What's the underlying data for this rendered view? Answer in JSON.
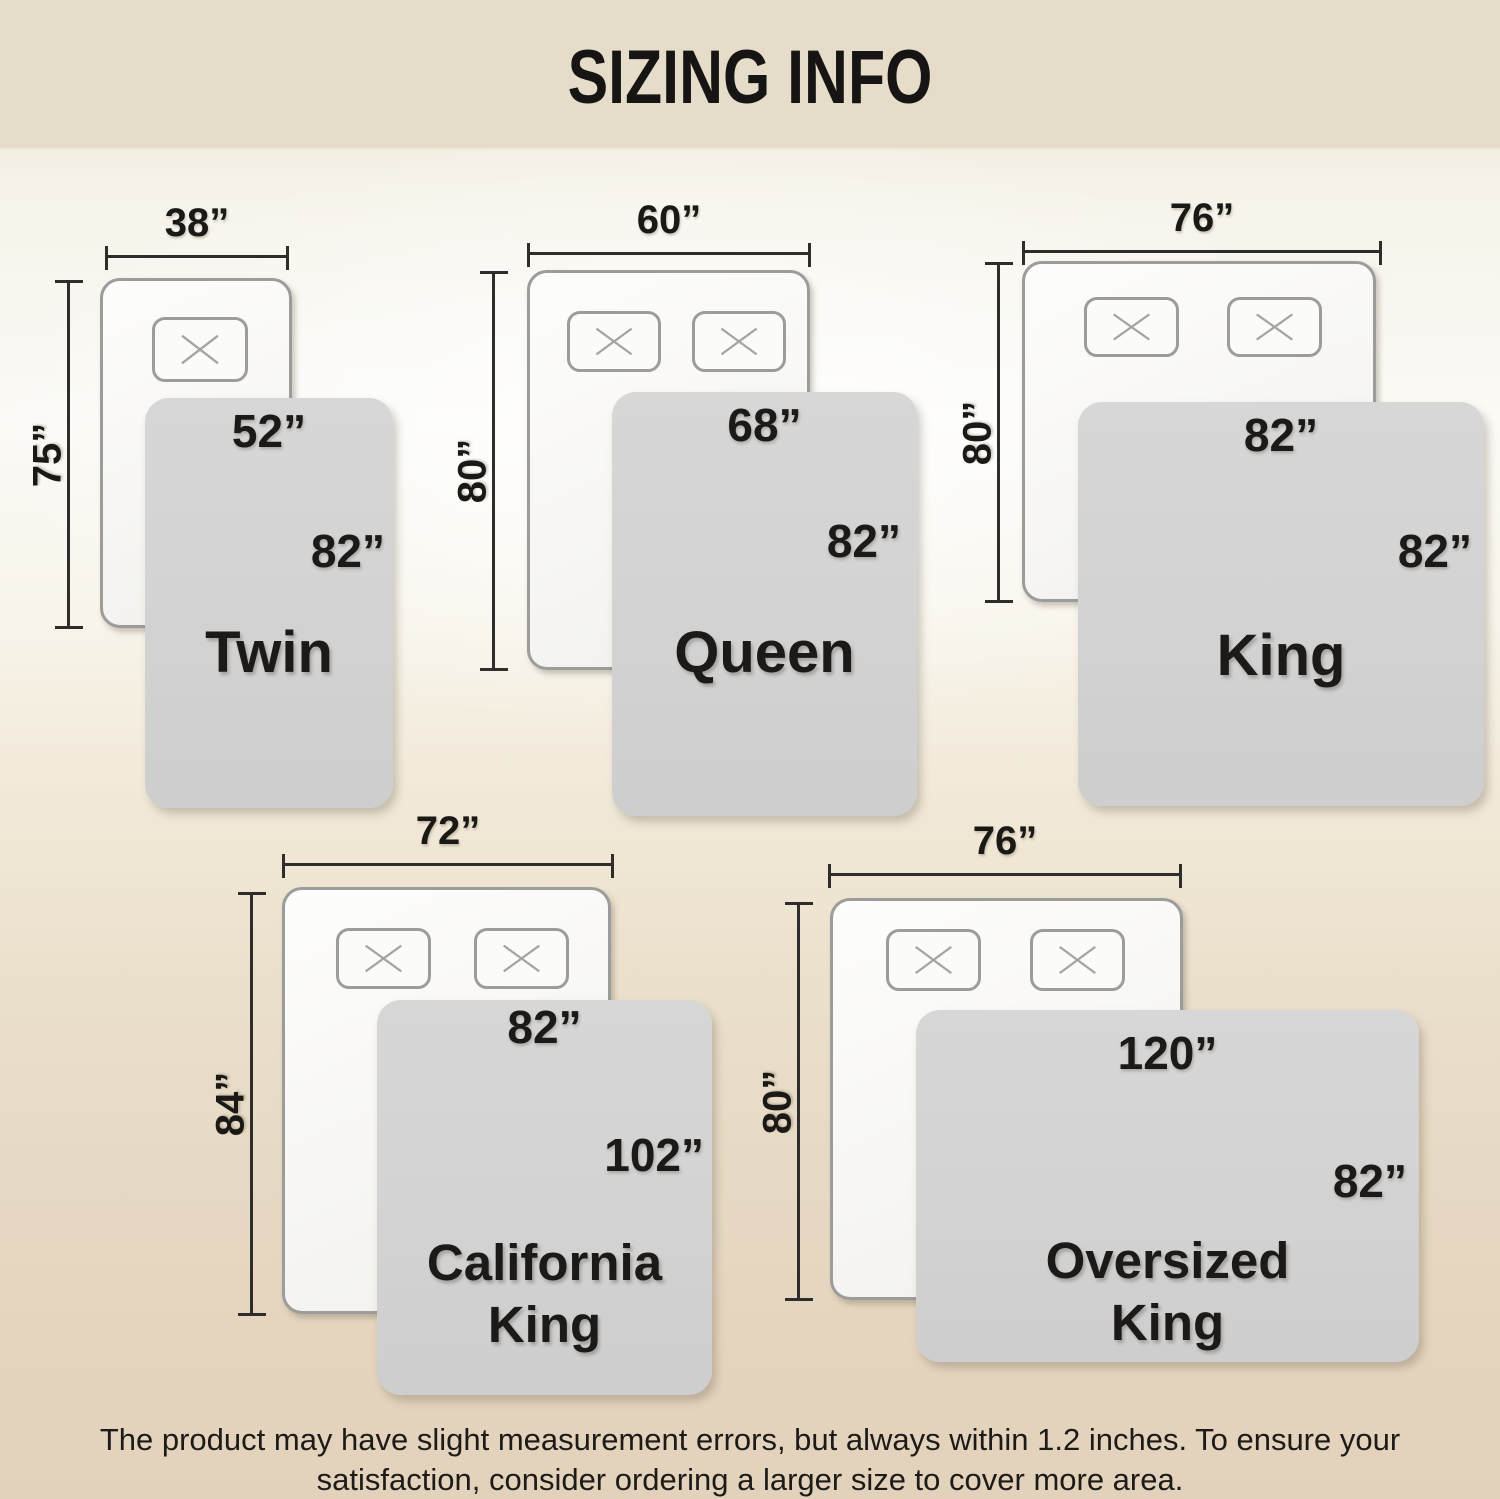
{
  "title": "SIZING INFO",
  "colors": {
    "header_bg": "#e5dcc9",
    "background_bottom": "#e3d2bb",
    "blanket_gray": "#d2d2d2",
    "bed_border": "#9c9c9b",
    "dimension_line": "#2f2d2b",
    "text": "#1b1916"
  },
  "icons": {
    "pillow": "x-cross"
  },
  "sizes": [
    {
      "name_line1": "Twin",
      "pillows": 1,
      "bed_width": "38”",
      "bed_length": "75”",
      "blanket_width": "52”",
      "blanket_length": "82”"
    },
    {
      "name_line1": "Queen",
      "pillows": 2,
      "bed_width": "60”",
      "bed_length": "80”",
      "blanket_width": "68”",
      "blanket_length": "82”"
    },
    {
      "name_line1": "King",
      "pillows": 2,
      "bed_width": "76”",
      "bed_length": "80”",
      "blanket_width": "82”",
      "blanket_length": "82”"
    },
    {
      "name_line1": "California",
      "name_line2": "King",
      "pillows": 2,
      "bed_width": "72”",
      "bed_length": "84”",
      "blanket_width": "82”",
      "blanket_length": "102”"
    },
    {
      "name_line1": "Oversized",
      "name_line2": "King",
      "pillows": 2,
      "bed_width": "76”",
      "bed_length": "80”",
      "blanket_width": "120”",
      "blanket_length": "82”"
    }
  ],
  "disclaimer": {
    "line1": "The product may have slight measurement errors, but always within 1.2 inches. To ensure your",
    "line2": "satisfaction, consider ordering a larger size to cover more area."
  }
}
